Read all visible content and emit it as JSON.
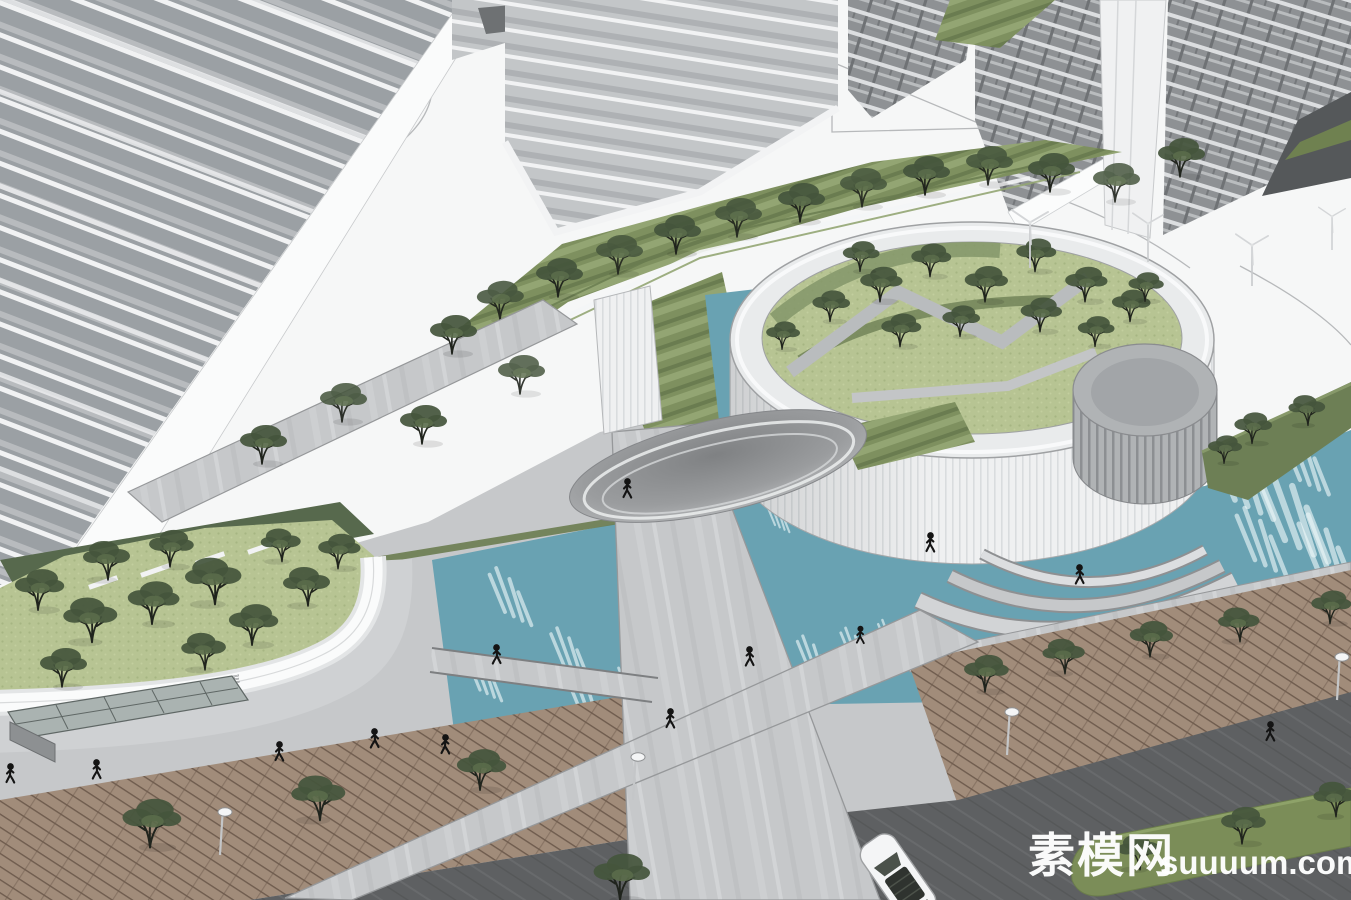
{
  "scene": {
    "title": "Residential complex aerial rendering",
    "style": "SketchUp-style 3D architectural model, aerial oblique view",
    "features": [
      "high-rise residential towers",
      "circular clubhouse with roof garden and trees",
      "small wind turbines",
      "cylindrical drum volume",
      "spiral ramp",
      "teal water plaza with fountain jets",
      "stone pedestrian walkways and bridges",
      "elliptical canopy",
      "wooden boardwalk with street trees",
      "asphalt road with green median",
      "street lamps",
      "white SUV",
      "pedestrian silhouettes",
      "entrance sign letters on curved wall",
      "glass skylight box"
    ]
  },
  "watermark": {
    "cn": "素模网",
    "en": "suuuum.com"
  },
  "signage": {
    "text": "LIFESTORE"
  },
  "palette": {
    "water": "#69a2b2",
    "streak": "#eef7f8",
    "lawn": "#b7c493",
    "hedge_dark": "#6a7c50",
    "hedge_light": "#93a573",
    "grass_dark": "#57694d",
    "foliage": "#45553c",
    "foliage2": "#5a6b4a",
    "trunk": "#20241d",
    "stone": "#c6c8ca",
    "plaza": "#f6f7f7",
    "facade_slab": "#f1f2f3",
    "facade_glass": "#9ba0a4",
    "circle_wall": "#eff0f1",
    "circle_rib": "#d9dcde",
    "drum": "#b0b3b5",
    "wood": "#a18c7a",
    "wood_line": "#6f5c4e",
    "road": "#5e6062",
    "median": "#7b8d58",
    "canopy_core": "#7f8183",
    "canopy_edge": "#c6c8ca",
    "people": "#141414",
    "watermark": "#ffffff"
  }
}
